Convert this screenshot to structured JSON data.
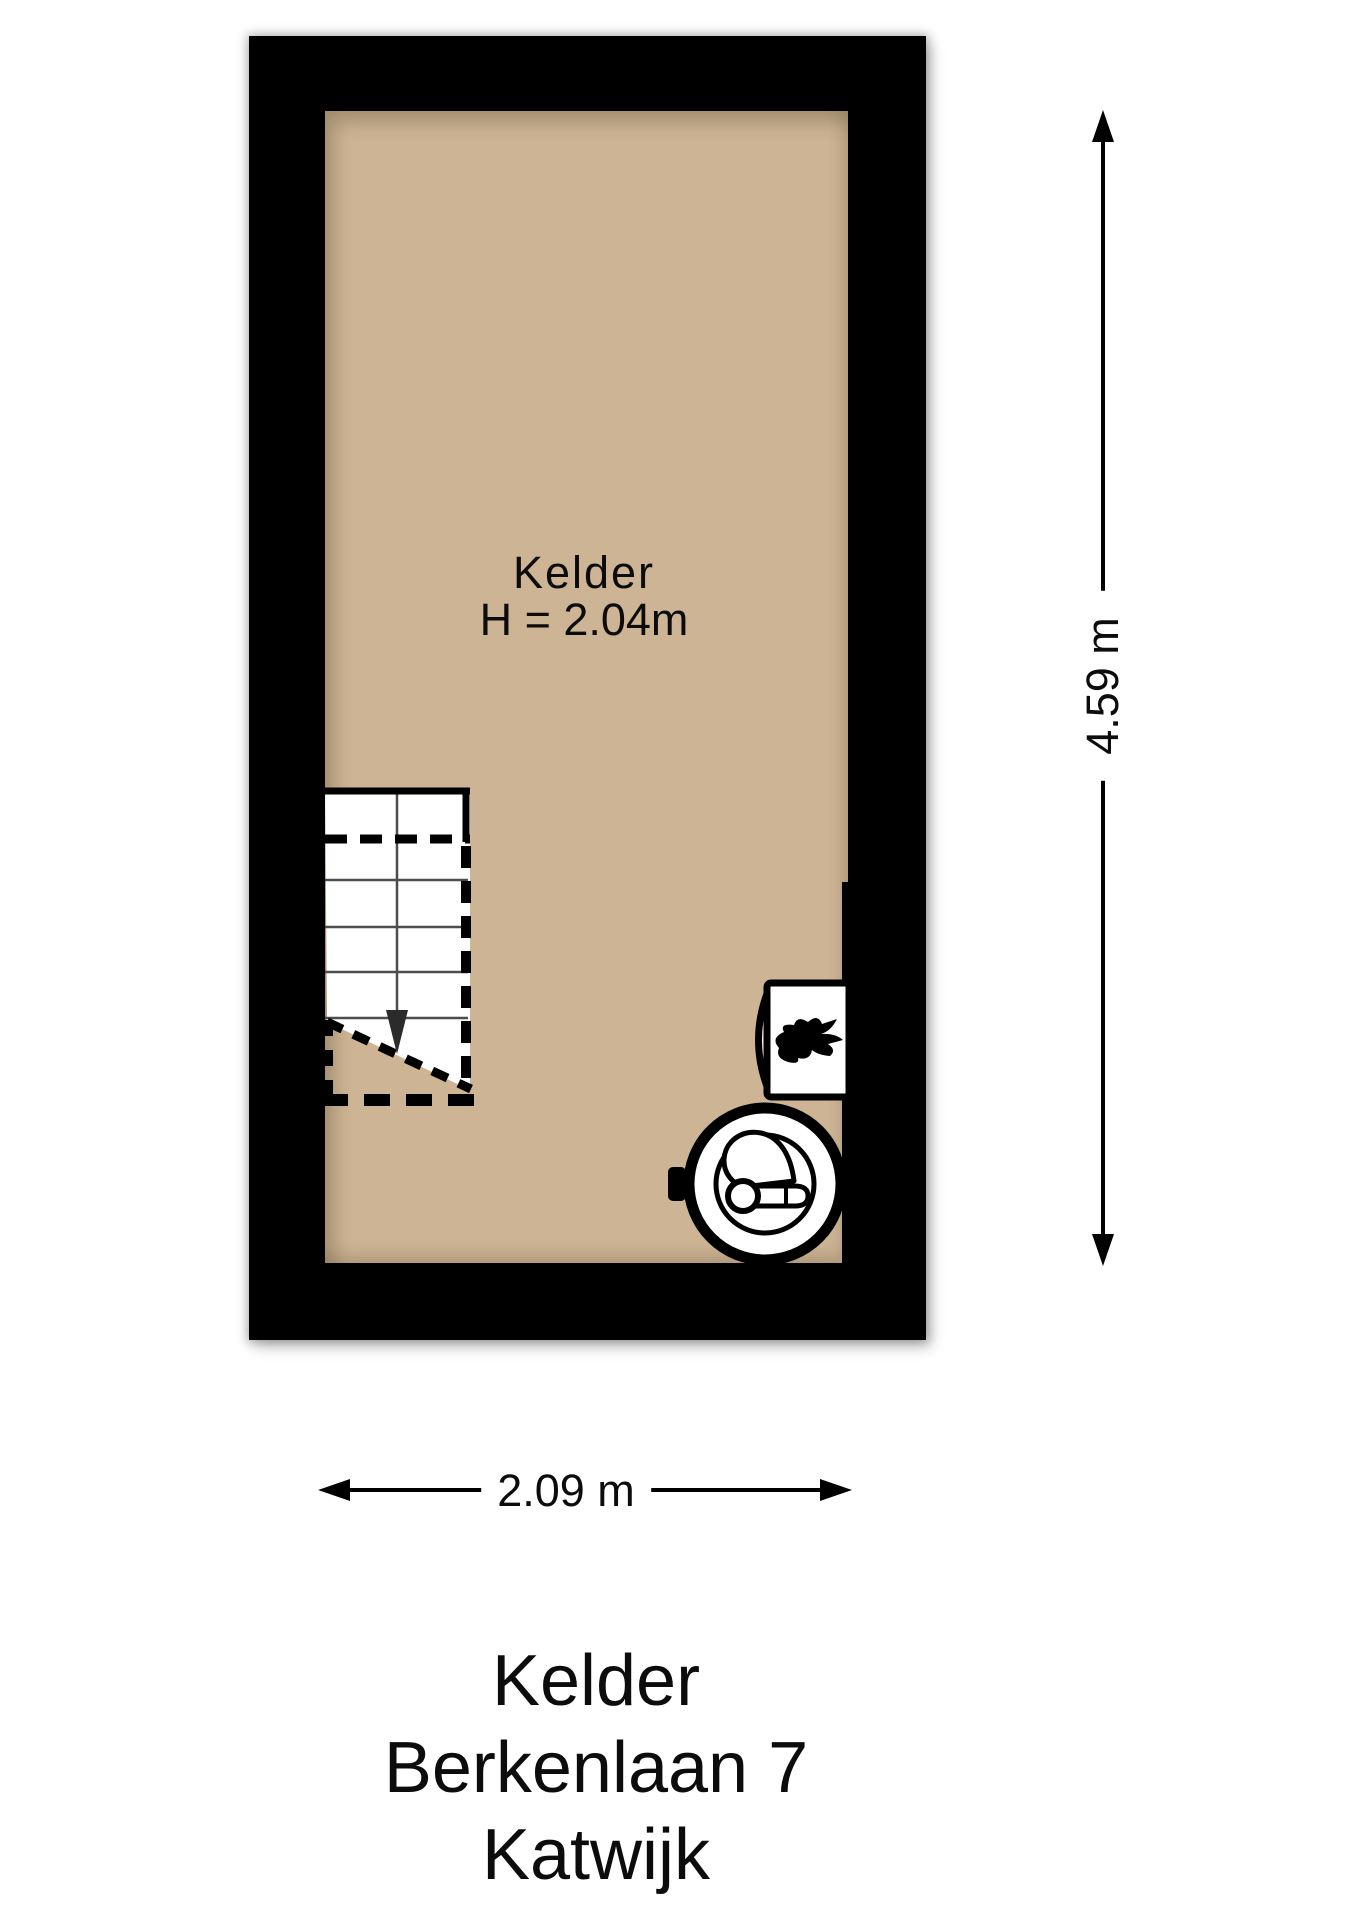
{
  "room": {
    "name": "Kelder",
    "height_label": "H = 2.04m"
  },
  "dimensions": {
    "vertical_label": "4.59 m",
    "horizontal_label": "2.09 m"
  },
  "title_lines": [
    "Kelder",
    "Berkenlaan 7",
    "Katwijk"
  ],
  "colors": {
    "floor": "#CCB494",
    "wall": "#000000",
    "line": "#000000"
  },
  "icons": {
    "boiler": "flame-icon",
    "water_tank": "water-tank-icon",
    "stairs_direction": "down-arrow-icon"
  }
}
